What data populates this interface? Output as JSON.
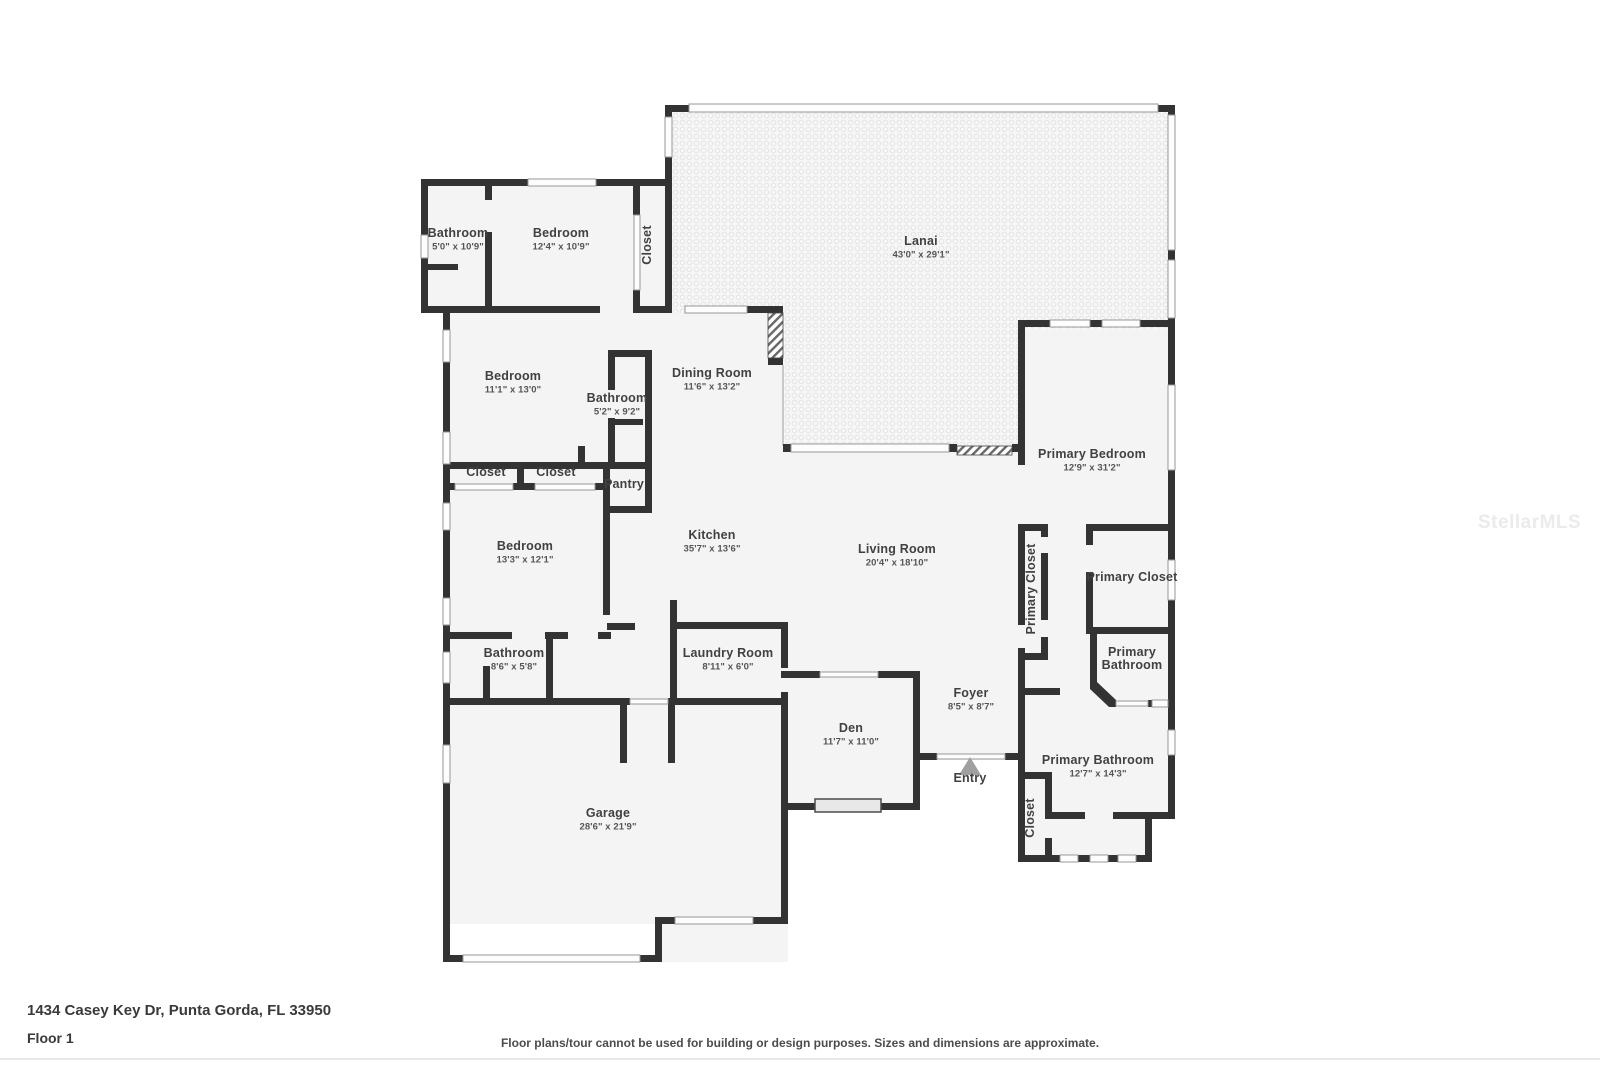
{
  "watermark": {
    "text": "StellarMLS"
  },
  "footer": {
    "address": "1434 Casey Key Dr, Punta Gorda, FL 33950",
    "floor_label": "Floor 1",
    "disclaimer": "Floor plans/tour cannot be used for building or design purposes. Sizes and dimensions are approximate."
  },
  "colors": {
    "wall": "#333333",
    "room_fill": "#f4f4f4",
    "lanai_fill": "#f7f7f7",
    "window_stroke": "#979797",
    "text": "#414141",
    "entry_marker": "#a0a0a0",
    "watermark": "#ebebeb"
  },
  "rooms": [
    {
      "label": "Bathroom",
      "dims": "5'0\" x 10'9\"",
      "x": 458,
      "y": 237,
      "rot": 0
    },
    {
      "label": "Bedroom",
      "dims": "12'4\" x 10'9\"",
      "x": 561,
      "y": 237,
      "rot": 0
    },
    {
      "label": "Closet",
      "dims": "",
      "x": 651,
      "y": 245,
      "rot": -90
    },
    {
      "label": "Lanai",
      "dims": "43'0\" x 29'1\"",
      "x": 921,
      "y": 245,
      "rot": 0
    },
    {
      "label": "Bedroom",
      "dims": "11'1\" x 13'0\"",
      "x": 513,
      "y": 380,
      "rot": 0
    },
    {
      "label": "Dining Room",
      "dims": "11'6\" x 13'2\"",
      "x": 712,
      "y": 377,
      "rot": 0
    },
    {
      "label": "Bathroom",
      "dims": "5'2\" x 9'2\"",
      "x": 617,
      "y": 402,
      "rot": 0
    },
    {
      "label": "Closet",
      "dims": "",
      "x": 486,
      "y": 476,
      "rot": 0
    },
    {
      "label": "Closet",
      "dims": "",
      "x": 556,
      "y": 476,
      "rot": 0
    },
    {
      "label": "Pantry",
      "dims": "",
      "x": 624,
      "y": 488,
      "rot": 0
    },
    {
      "label": "Bedroom",
      "dims": "13'3\" x 12'1\"",
      "x": 525,
      "y": 550,
      "rot": 0
    },
    {
      "label": "Kitchen",
      "dims": "35'7\" x 13'6\"",
      "x": 712,
      "y": 539,
      "rot": 0
    },
    {
      "label": "Living Room",
      "dims": "20'4\" x 18'10\"",
      "x": 897,
      "y": 553,
      "rot": 0
    },
    {
      "label": "Primary Bedroom",
      "dims": "12'9\" x 31'2\"",
      "x": 1092,
      "y": 458,
      "rot": 0
    },
    {
      "label": "Primary Closet",
      "dims": "",
      "x": 1035,
      "y": 589,
      "rot": -90
    },
    {
      "label": "Primary Closet",
      "dims": "",
      "x": 1132,
      "y": 581,
      "rot": 0
    },
    {
      "label": "Primary",
      "label2": "Bathroom",
      "dims": "",
      "x": 1132,
      "y": 656,
      "rot": 0
    },
    {
      "label": "Bathroom",
      "dims": "8'6\" x 5'8\"",
      "x": 514,
      "y": 657,
      "rot": 0
    },
    {
      "label": "Laundry Room",
      "dims": "8'11\" x 6'0\"",
      "x": 728,
      "y": 657,
      "rot": 0
    },
    {
      "label": "Foyer",
      "dims": "8'5\" x 8'7\"",
      "x": 971,
      "y": 697,
      "rot": 0
    },
    {
      "label": "Den",
      "dims": "11'7\" x 11'0\"",
      "x": 851,
      "y": 732,
      "rot": 0
    },
    {
      "label": "Entry",
      "dims": "",
      "x": 970,
      "y": 782,
      "rot": 0
    },
    {
      "label": "Primary Bathroom",
      "dims": "12'7\" x 14'3\"",
      "x": 1098,
      "y": 764,
      "rot": 0
    },
    {
      "label": "Closet",
      "dims": "",
      "x": 1034,
      "y": 818,
      "rot": -90
    },
    {
      "label": "Garage",
      "dims": "28'6\" x 21'9\"",
      "x": 608,
      "y": 817,
      "rot": 0
    }
  ]
}
